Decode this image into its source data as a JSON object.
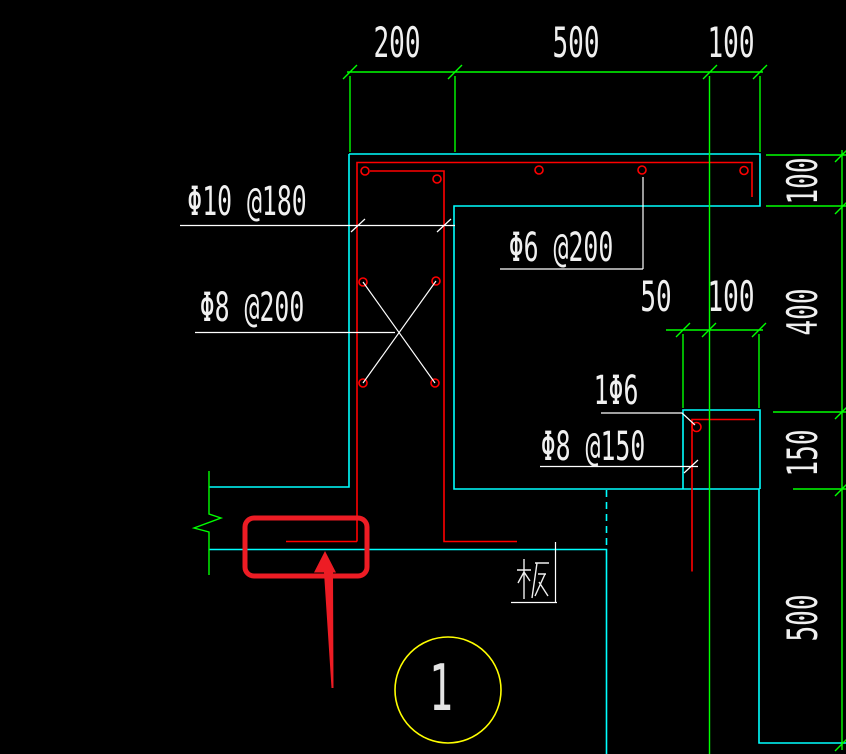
{
  "drawing": {
    "top_dimensions": [
      "200",
      "500",
      "100"
    ],
    "bracket_dimensions": [
      "50",
      "100"
    ],
    "right_dimensions": [
      "100",
      "400",
      "150",
      "500"
    ],
    "rebar_labels": {
      "wall_vertical_bars": "Φ10 @180",
      "wall_tie_bars": "Φ8 @200",
      "top_flange_bars": "Φ6 @200",
      "bracket_corner_bar": "1Φ6",
      "bracket_stirrups": "Φ8 @150"
    },
    "slab_label": "板",
    "section_marker": "1",
    "colors": {
      "background": "#000000",
      "concrete_outline": "#00ffff",
      "rebar": "#ff0000",
      "dimension_lines": "#00ff00",
      "leader_lines": "#ffffff",
      "text": "#f0f0f0",
      "section_marker_circle": "#ffff00",
      "annotation_highlight": "#ed1c24"
    }
  }
}
